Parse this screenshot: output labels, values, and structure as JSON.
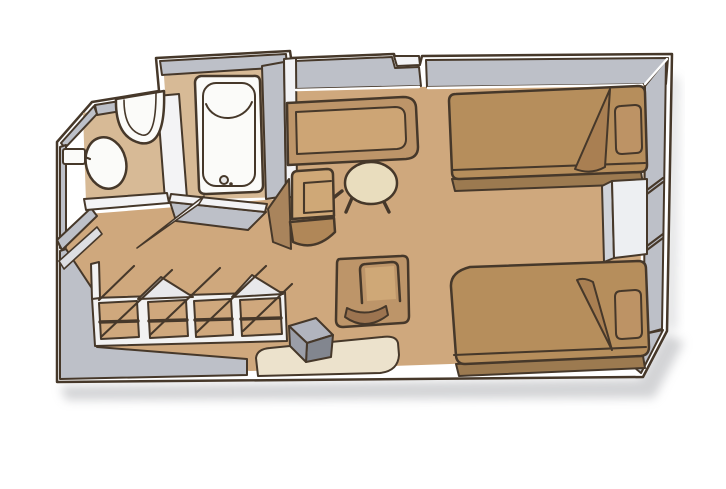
{
  "diagram": {
    "type": "floor-plan",
    "subject": "cruise-ship-stateroom-cabin",
    "style": "isometric-illustration",
    "rooms": [
      {
        "name": "bathroom",
        "items": [
          "toilet",
          "wall-sink",
          "bathtub"
        ]
      },
      {
        "name": "entry-corridor",
        "items": [
          "entry-door-leaf",
          "bathroom-door-leaf",
          "angled-wall"
        ]
      },
      {
        "name": "wardrobe-row",
        "items": [
          "closet-1",
          "closet-2",
          "closet-3",
          "closet-4",
          "hanging-rods",
          "open-door-tents"
        ]
      },
      {
        "name": "living-area",
        "items": [
          "sofa",
          "round-table",
          "armchair-left",
          "armchair-front",
          "stool",
          "vanity-desk"
        ]
      },
      {
        "name": "sleeping-area",
        "items": [
          "twin-bed-top",
          "twin-bed-bottom",
          "pillow-top",
          "pillow-bottom",
          "nightstand",
          "turned-down-blanket-top",
          "turned-down-blanket-bottom"
        ]
      }
    ],
    "palette": {
      "background": "#ffffff",
      "outline": "#46382a",
      "wall": "#bdc0c8",
      "wall_face": "#f3f3f5",
      "trim": "#ffffff",
      "floor_main": "#cfa87d",
      "floor_bath": "#d7ba96",
      "fixture_white": "#fbfbf9",
      "frame_white": "#f2f2f2",
      "tent_gray": "#e8e8eb",
      "door_leaf": "#dddee2",
      "leaf_white": "#fafafa",
      "bed": "#b68e5c",
      "bed_side": "#9c7a50",
      "bed_fold": "#a97f52",
      "pillow": "#bd9365",
      "sofa": "#bd9569",
      "sofa_seat": "#cda575",
      "chair": "#bd9569",
      "chair_top": "#cfa877",
      "chair_seat": "#b08758",
      "chair_shadow": "#9c7450",
      "chair_side": "#a9845c",
      "table": "#e9ddbe",
      "desk": "#ece2cc",
      "stool_top": "#b1b4be",
      "stool_front": "#82868f",
      "stool_side": "#9b9ea8",
      "nightstand_top": "#d0d3d9",
      "nightstand_front": "#edeff2",
      "shadow": "#a6a7ac"
    }
  }
}
